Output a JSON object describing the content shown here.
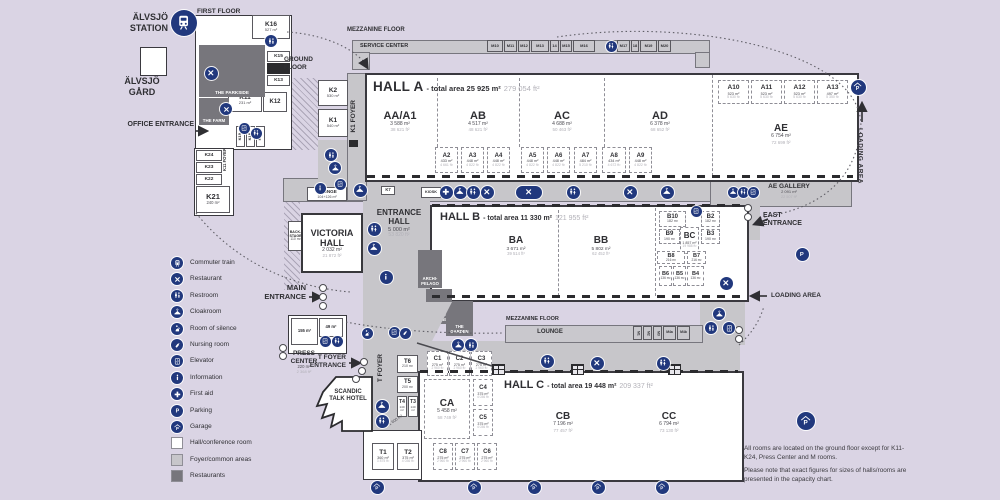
{
  "texts": {
    "station_l1": "ÄLVSJÖ",
    "station_l2": "STATION",
    "gard_l1": "ÄLVSJÖ",
    "gard_l2": "GÅRD",
    "first_floor": "FIRST FLOOR",
    "ground_floor": "GROUND FLOOR",
    "mezzanine_top": "MEZZANINE FLOOR",
    "service_center": "SERVICE CENTER",
    "mezzanine_mid": "MEZZANINE FLOOR",
    "lounge_mid": "LOUNGE",
    "office_entrance": "OFFICE ENTRANCE",
    "main_entrance": "MAIN ENTRANCE",
    "east_entrance": "EAST ENTRANCE",
    "t_foyer_entrance": "T FOYER ENTRANCE",
    "loading_area_right": "LOADING AREA",
    "loading_area_mid": "LOADING AREA",
    "k1_foyer": "K1 FOYER",
    "k11_foyer": "K11 FOYER",
    "t_foyer": "T FOYER",
    "kiosk": "KIOSK",
    "press_center": "PRESS CENTER",
    "press_m": "220 m²",
    "press_f": "2 368 ft²",
    "scandic": "SCANDIC TALK HOTEL",
    "notes": [
      "All rooms are located on the ground floor except for K11-K24, Press Center and M rooms.",
      "Please note that exact figures for sizes of halls/rooms are presented in the capacity chart."
    ]
  },
  "halls": {
    "a": {
      "name": "HALL A",
      "total": "- total area 25 925 m²",
      "ft": "279 054 ft²"
    },
    "b": {
      "name": "HALL B",
      "total": "- total area 11 330 m²",
      "ft": "121 955 ft²"
    },
    "c": {
      "name": "HALL C",
      "total": "- total area 19 448 m²",
      "ft": "209 337 ft²"
    }
  },
  "areas": {
    "AA": {
      "n": "AA/A1",
      "m": "3 588 m²",
      "f": "38 621 ft²"
    },
    "AB": {
      "n": "AB",
      "m": "4 517 m²",
      "f": "48 621 ft²"
    },
    "AC": {
      "n": "AC",
      "m": "4 688 m²",
      "f": "50 463 ft²"
    },
    "AD": {
      "n": "AD",
      "m": "6 378 m²",
      "f": "68 652 ft²"
    },
    "AE": {
      "n": "AE",
      "m": "6 754 m²",
      "f": "72 699 ft²"
    },
    "AEG": {
      "n": "AE GALLERY",
      "m": "2 091 m²",
      "f": "22 507 ft²"
    },
    "BA": {
      "n": "BA",
      "m": "3 671 m²",
      "f": "39 514 ft²"
    },
    "BB": {
      "n": "BB",
      "m": "5 802 m²",
      "f": "62 452 ft²"
    },
    "CA": {
      "n": "CA",
      "m": "5 458 m²",
      "f": "58 749 ft²"
    },
    "CB": {
      "n": "CB",
      "m": "7 196 m²",
      "f": "77 457 ft²"
    },
    "CC": {
      "n": "CC",
      "m": "6 794 m²",
      "f": "73 130 ft²"
    },
    "VICTORIA": {
      "n": "VICTORIA HALL",
      "m": "2 032 m²",
      "f": "21 872 ft²"
    },
    "ENTRANCE": {
      "n": "ENTRANCE HALL",
      "m": "5 000 m²",
      "f": "53 820 ft²"
    },
    "TFOYER_M": "1 600 m²"
  },
  "rooms": {
    "K16": {
      "n": "K16",
      "m": "527 m²"
    },
    "K15": {
      "n": "K15"
    },
    "K13": {
      "n": "K13"
    },
    "K11": {
      "n": "K11",
      "m": "231 m²"
    },
    "K12": {
      "n": "K12"
    },
    "K24": {
      "n": "K24"
    },
    "K23": {
      "n": "K23"
    },
    "K22": {
      "n": "K22"
    },
    "K21": {
      "n": "K21",
      "m": "240 m²"
    },
    "K19": {
      "n": "K19"
    },
    "K18": {
      "n": "K18"
    },
    "K17": {
      "n": "K17"
    },
    "K1": {
      "n": "K1",
      "m": "540 m²"
    },
    "K2": {
      "n": "K2",
      "m": "530 m²"
    },
    "K7": {
      "n": "K7"
    },
    "LOUNGE_K": {
      "n": "LOUNGE",
      "m": "104+126 m²"
    },
    "BACKSTAGE": {
      "n": "BACK-\nSTAGE",
      "m": "110 m²"
    },
    "PC1": {
      "n": "155 m²"
    },
    "PC2": {
      "n": "49 m²"
    },
    "A2": {
      "n": "A2",
      "m": "433 m²",
      "f": "4 661 ft²"
    },
    "A3": {
      "n": "A3",
      "m": "448 m²",
      "f": "4 822 ft²"
    },
    "A4": {
      "n": "A4",
      "m": "448 m²",
      "f": "4 822 ft²"
    },
    "A5": {
      "n": "A5",
      "m": "448 m²",
      "f": "4 822 ft²"
    },
    "A6": {
      "n": "A6",
      "m": "448 m²",
      "f": "4 822 ft²"
    },
    "A7": {
      "n": "A7",
      "m": "484 m²",
      "f": "5 210 ft²"
    },
    "A8": {
      "n": "A8",
      "m": "434 m²",
      "f": "4 672 ft²"
    },
    "A9": {
      "n": "A9",
      "m": "448 m²",
      "f": "4 822 ft²"
    },
    "A10": {
      "n": "A10",
      "m": "523 m²",
      "f": "5 630 ft²"
    },
    "A11": {
      "n": "A11",
      "m": "523 m²",
      "f": "5 630 ft²"
    },
    "A12": {
      "n": "A12",
      "m": "523 m²",
      "f": "5 630 ft²"
    },
    "A13": {
      "n": "A13",
      "m": "497 m²",
      "f": "5 350 ft²"
    },
    "B10": {
      "n": "B10",
      "m": "182 m²"
    },
    "B2": {
      "n": "B2",
      "m": "182 m²"
    },
    "B9": {
      "n": "B9",
      "m": "190 m²"
    },
    "B3": {
      "n": "B3",
      "m": "190 m²"
    },
    "BC": {
      "n": "BC",
      "m": "1 857 m²",
      "f": "19 988 ft²"
    },
    "B8": {
      "n": "B8",
      "m": "216 m²"
    },
    "B7": {
      "n": "B7",
      "m": "216 m²"
    },
    "B6": {
      "n": "B6",
      "m": "136 m²"
    },
    "B5": {
      "n": "B5",
      "m": "136 m²"
    },
    "B4": {
      "n": "B4",
      "m": "136 m²"
    },
    "C1": {
      "n": "C1",
      "m": "275 m²",
      "f": "2 960 ft²"
    },
    "C2": {
      "n": "C2",
      "m": "275 m²",
      "f": "2 960 ft²"
    },
    "C3": {
      "n": "C3",
      "m": "275 m²",
      "f": "2 960 ft²"
    },
    "C4": {
      "n": "C4",
      "m": "375 m²",
      "f": "4 036 ft²"
    },
    "C5": {
      "n": "C5",
      "m": "375 m²",
      "f": "4 036 ft²"
    },
    "C6": {
      "n": "C6",
      "m": "275 m²",
      "f": "2 960 ft²"
    },
    "C7": {
      "n": "C7",
      "m": "275 m²",
      "f": "2 960 ft²"
    },
    "C8": {
      "n": "C8",
      "m": "275 m²",
      "f": "2 960 ft²"
    },
    "T1": {
      "n": "T1",
      "m": "360 m²",
      "f": "3 875 ft²"
    },
    "T2": {
      "n": "T2",
      "m": "375 m²",
      "f": "4 036 ft²"
    },
    "T3": {
      "n": "T3",
      "m": "140 m²"
    },
    "T4": {
      "n": "T4",
      "m": "140 m²"
    },
    "T5": {
      "n": "T5",
      "m": "200 m²"
    },
    "T6": {
      "n": "T6",
      "m": "210 m²"
    }
  },
  "mrooms_top": [
    "M10",
    "M11",
    "M12",
    "M13",
    "14",
    "M15",
    "M16",
    "M17",
    "18",
    "M19",
    "M20"
  ],
  "mrooms_lounge": [
    "M1",
    "M2",
    "M3",
    "M4a",
    "M4b"
  ],
  "restaurants": {
    "parkside": "THE PARKSIDE",
    "farm": "THE FARM",
    "archipelago": "ARCHI-PELAGO",
    "flavour": "FLAVOUR KITCHEN",
    "garden": "THE GARDEN"
  },
  "legend": [
    "Commuter train",
    "Restaurant",
    "Restroom",
    "Cloakroom",
    "Room of silence",
    "Nursing room",
    "Elevator",
    "Information",
    "First aid",
    "Parking",
    "Garage",
    "Hall/conference room",
    "Foyer/common areas",
    "Restaurants"
  ],
  "palette": {
    "navy": "#21387d",
    "foyer": "#c7c6ca",
    "restaurant_gray": "#77767c",
    "bg": "#dad4e4"
  }
}
